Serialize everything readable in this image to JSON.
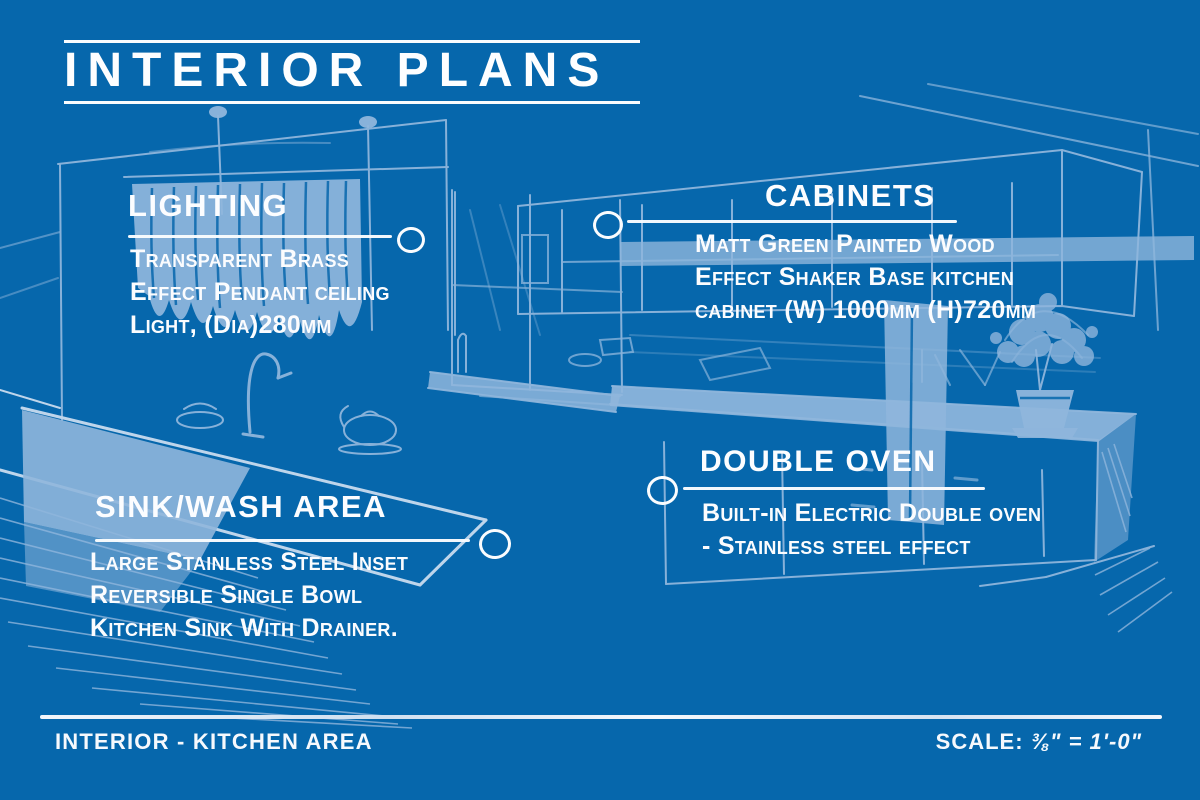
{
  "title": "INTERIOR PLANS",
  "annotations": {
    "lighting": {
      "heading": "LIGHTING",
      "body": "Transparent Brass\nEffect Pendant ceiling\nLight, (Dia)280mm"
    },
    "cabinets": {
      "heading": "CABINETS",
      "body": "Matt Green Painted Wood\nEffect Shaker Base kitchen\ncabinet (W) 1000mm (H)720mm"
    },
    "sink_wash": {
      "heading": "SINK/WASH AREA",
      "body": "Large Stainless Steel Inset\nReversible Single Bowl\nKitchen Sink With Drainer."
    },
    "double_oven": {
      "heading": "DOUBLE OVEN",
      "body": "Built-in Electric Double oven\n- Stainless steel effect"
    }
  },
  "footer": {
    "left": "INTERIOR - KITCHEN AREA",
    "scale_label": "SCALE:",
    "scale_value": "⅜\" = 1'-0\""
  },
  "colors": {
    "background": "#0667ac",
    "sketch_line": "#8fb6dc",
    "text": "#fdfdfe"
  },
  "sketch_elements": [
    "pendant-lights",
    "window-curtain",
    "kitchen-island",
    "sink-faucet",
    "upper-cabinets",
    "base-counter",
    "potted-plant",
    "kettle",
    "fruit-bowl"
  ]
}
